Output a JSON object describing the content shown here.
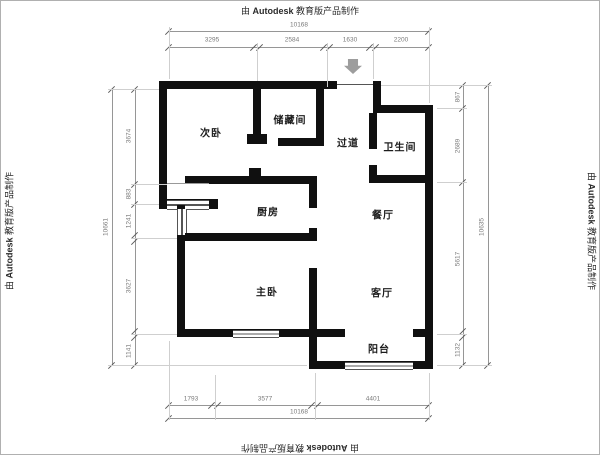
{
  "watermark": {
    "prefix": "由",
    "brand": "Autodesk",
    "suffix": "教育版产品制作"
  },
  "rooms": {
    "secondary_bedroom": "次卧",
    "storage": "储藏间",
    "hallway": "过道",
    "bathroom": "卫生间",
    "kitchen": "厨房",
    "dining": "餐厅",
    "master_bedroom": "主卧",
    "living": "客厅",
    "balcony": "阳台"
  },
  "dimensions": {
    "top": {
      "total": "10168",
      "segments": [
        "3295",
        "2584",
        "1630",
        "2200"
      ]
    },
    "bottom": {
      "total": "10168",
      "segments": [
        "1793",
        "3577",
        "4401"
      ]
    },
    "left": {
      "total": "10661",
      "segments": [
        "3674",
        "883",
        "1241",
        "3627",
        "1141"
      ]
    },
    "right": {
      "total": "10635",
      "segments": [
        "867",
        "2689",
        "5617",
        "1132"
      ]
    }
  },
  "colors": {
    "wall": "#101010",
    "dimension_line": "#969696",
    "dimension_text": "#7a7a7a",
    "room_text": "#1c1c1c",
    "arrow_fill": "#9d9d9d"
  }
}
